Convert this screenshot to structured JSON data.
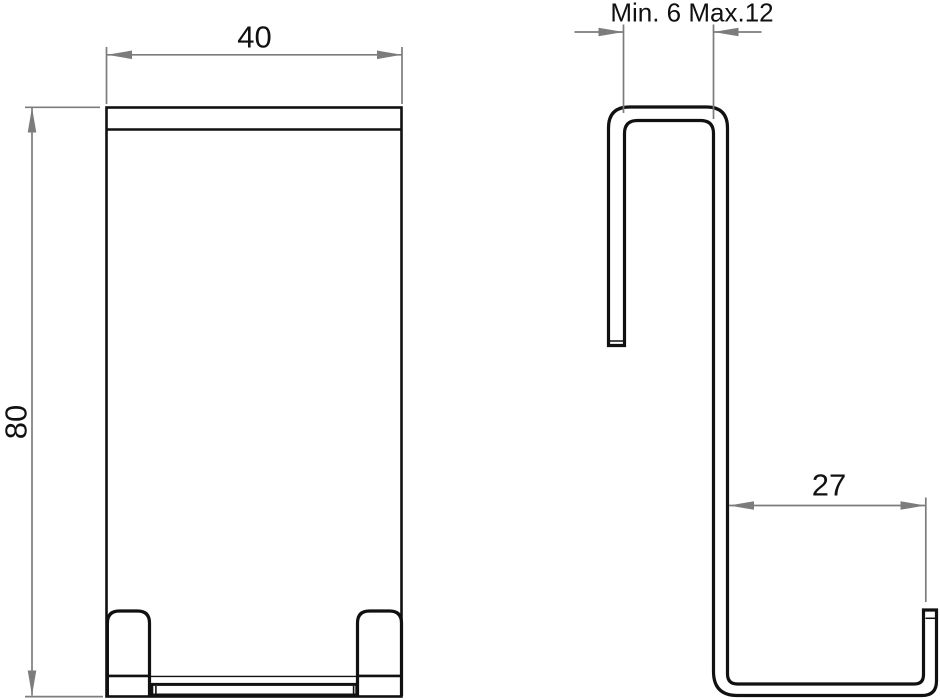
{
  "colors": {
    "line": "#111111",
    "dimension": "#7c7c7c",
    "background": "#ffffff"
  },
  "dimensions": {
    "width": {
      "value": "40"
    },
    "height": {
      "value": "80"
    },
    "opening": {
      "value": "Min. 6 Max.12"
    },
    "arm_length": {
      "value": "27"
    }
  }
}
